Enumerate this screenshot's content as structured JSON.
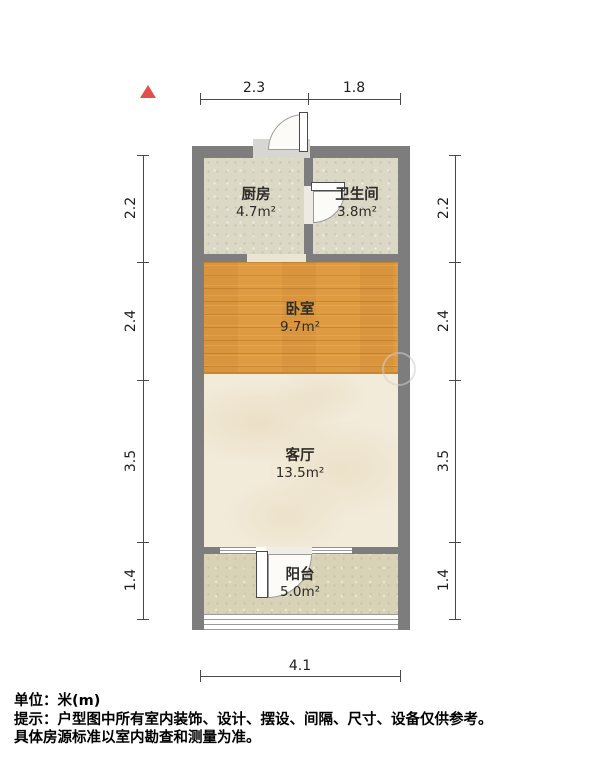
{
  "dimensions": {
    "top": [
      "2.3",
      "1.8"
    ],
    "left": [
      "2.2",
      "2.4",
      "3.5",
      "1.4"
    ],
    "right": [
      "2.2",
      "2.4",
      "3.5",
      "1.4"
    ],
    "bottom": [
      "4.1"
    ]
  },
  "rooms": [
    {
      "name": "厨房",
      "area": "4.7m²"
    },
    {
      "name": "卫生间",
      "area": "3.8m²"
    },
    {
      "name": "卧室",
      "area": "9.7m²"
    },
    {
      "name": "客厅",
      "area": "13.5m²"
    },
    {
      "name": "阳台",
      "area": "5.0m²"
    }
  ],
  "footer": {
    "unit": "单位：米(m)",
    "tip1": "提示：户型图中所有室内装饰、设计、摆设、间隔、尺寸、设备仅供参考。",
    "tip2": "具体房源标准以室内勘查和测量为准。"
  },
  "colors": {
    "wall": "#7d7d7d",
    "wood_floor": "#df9b41",
    "tile_floor": "#dbd8c5",
    "marble_floor": "#f2ebda",
    "balcony_floor": "#d8d3b7",
    "north_indicator": "#e2504e"
  }
}
